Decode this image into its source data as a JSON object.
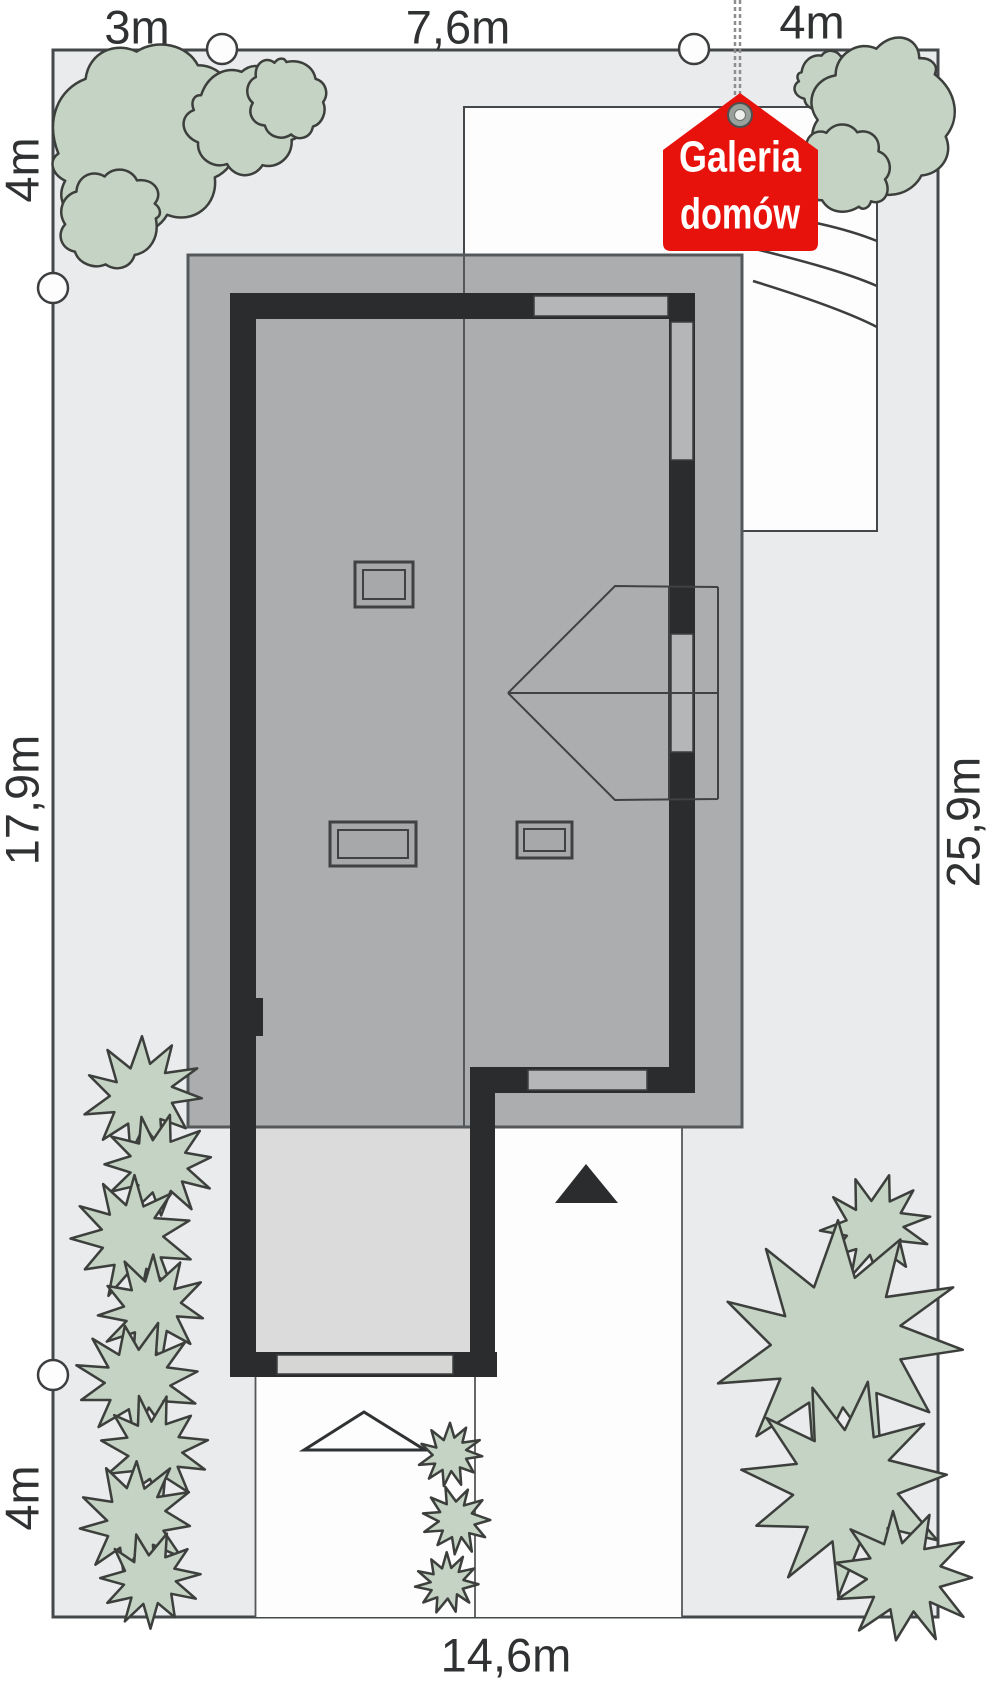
{
  "plan": {
    "dimensions": {
      "top": [
        {
          "label": "3m"
        },
        {
          "label": "7,6m"
        },
        {
          "label": "4m"
        }
      ],
      "left": [
        {
          "label": "4m"
        },
        {
          "label": "17,9m"
        },
        {
          "label": "4m"
        }
      ],
      "right": [
        {
          "label": "25,9m"
        }
      ],
      "bottom": [
        {
          "label": "14,6m"
        }
      ]
    },
    "logo": {
      "line1": "Galeria",
      "line2": "domów"
    },
    "markers": {
      "boundary_point_count": 4,
      "driveway_arrow": "filled-up-triangle",
      "gate_arrow": "outlined-up-triangle",
      "skylight_count": 3
    },
    "colors": {
      "plot_fill": "#e9ebed",
      "outside_fill": "#ffffff",
      "roof_fill": "#acadae",
      "wall_fill": "#2b2c2d",
      "terrace_fill": "#dadbda",
      "paving_fill": "#fdfdfe",
      "opening_fill": "#b5b6b7",
      "gate_fill": "#d6d7d5",
      "tree_fill": "#c4d3c4",
      "line_color": "#45484a",
      "logo_red": "#e8120d",
      "text_color": "#2f3132"
    }
  }
}
